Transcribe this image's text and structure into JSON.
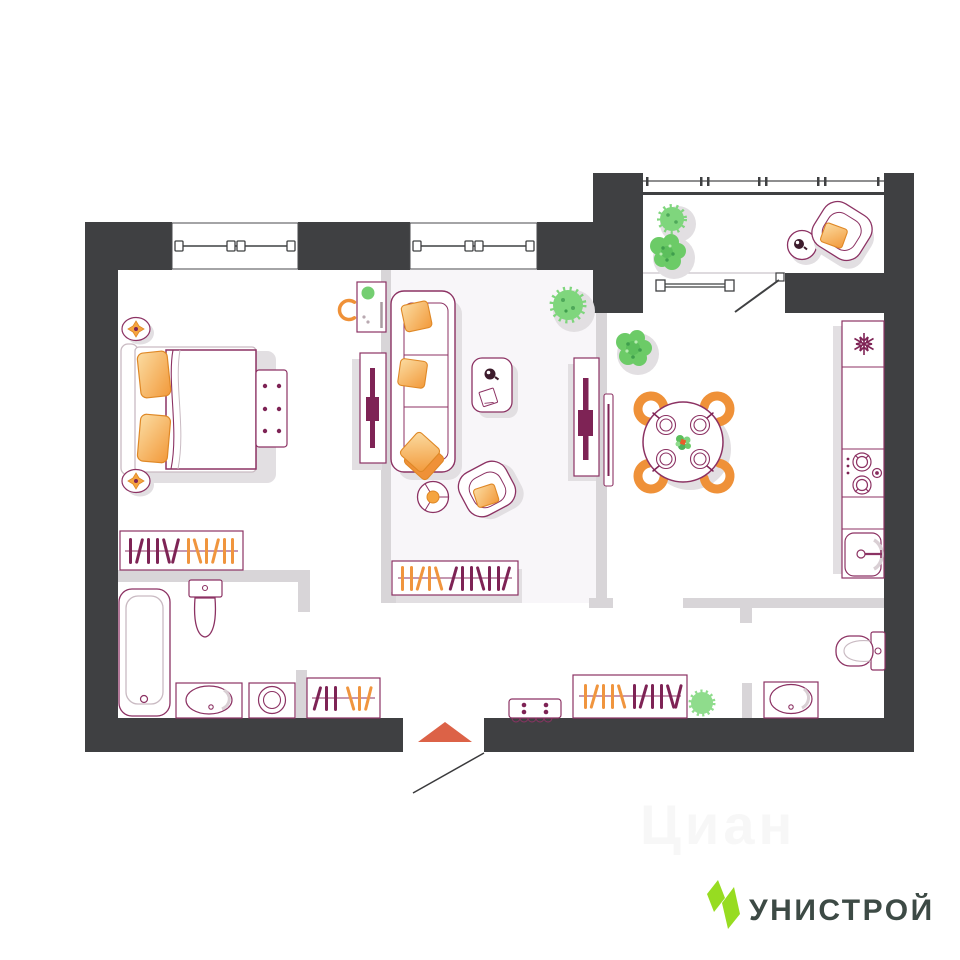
{
  "page": {
    "type": "apartment-floor-plan",
    "background": "#ffffff"
  },
  "brand": {
    "logo_text": "УНИСТРОЙ",
    "logo_green": "#97DC21",
    "logo_text_color": "#3D4A45"
  },
  "watermark": {
    "text": "Циан"
  },
  "palette": {
    "wall": "#3F4042",
    "partition": "#D8D5D8",
    "furniture_outline": "#8C3263",
    "furniture_accent": "#7E2355",
    "orange": "#F0953E",
    "orange_light": "#FBDCA2",
    "chair_orange": "#EF9138",
    "green": "#6CCB67",
    "shadow": "#E2DFE2",
    "entry_arrow": "#DC6247"
  },
  "floor_plan": {
    "windows_count": 3,
    "entry_marker": "orange-up-arrow",
    "rooms": [
      {
        "name": "bedroom",
        "furniture": [
          "double-bed",
          "orange-pillows",
          "nightstand-lamp",
          "nightstand-lamp",
          "bench-chest",
          "desk",
          "desk-chair",
          "tv-console",
          "wardrobe-hangers"
        ]
      },
      {
        "name": "living-room",
        "furniture": [
          "sofa",
          "coffee-table",
          "armchair",
          "floor-lamp",
          "tv-console",
          "wardrobe-hangers",
          "spiky-plant"
        ]
      },
      {
        "name": "kitchen-dining",
        "furniture": [
          "round-dining-table",
          "four-orange-chairs",
          "wall-tv",
          "bush-plant",
          "fridge",
          "stove",
          "sink",
          "counter"
        ]
      },
      {
        "name": "bathroom",
        "furniture": [
          "bathtub",
          "toilet",
          "washbasin",
          "washing-machine",
          "wardrobe-hangers"
        ]
      },
      {
        "name": "hallway",
        "furniture": [
          "wardrobe-hangers",
          "wardrobe-hangers",
          "shoe-bench",
          "plant"
        ]
      },
      {
        "name": "wc",
        "furniture": [
          "toilet",
          "washbasin"
        ]
      },
      {
        "name": "balcony",
        "furniture": [
          "armchair",
          "side-table",
          "spiky-plant",
          "bush-plant"
        ]
      }
    ]
  }
}
